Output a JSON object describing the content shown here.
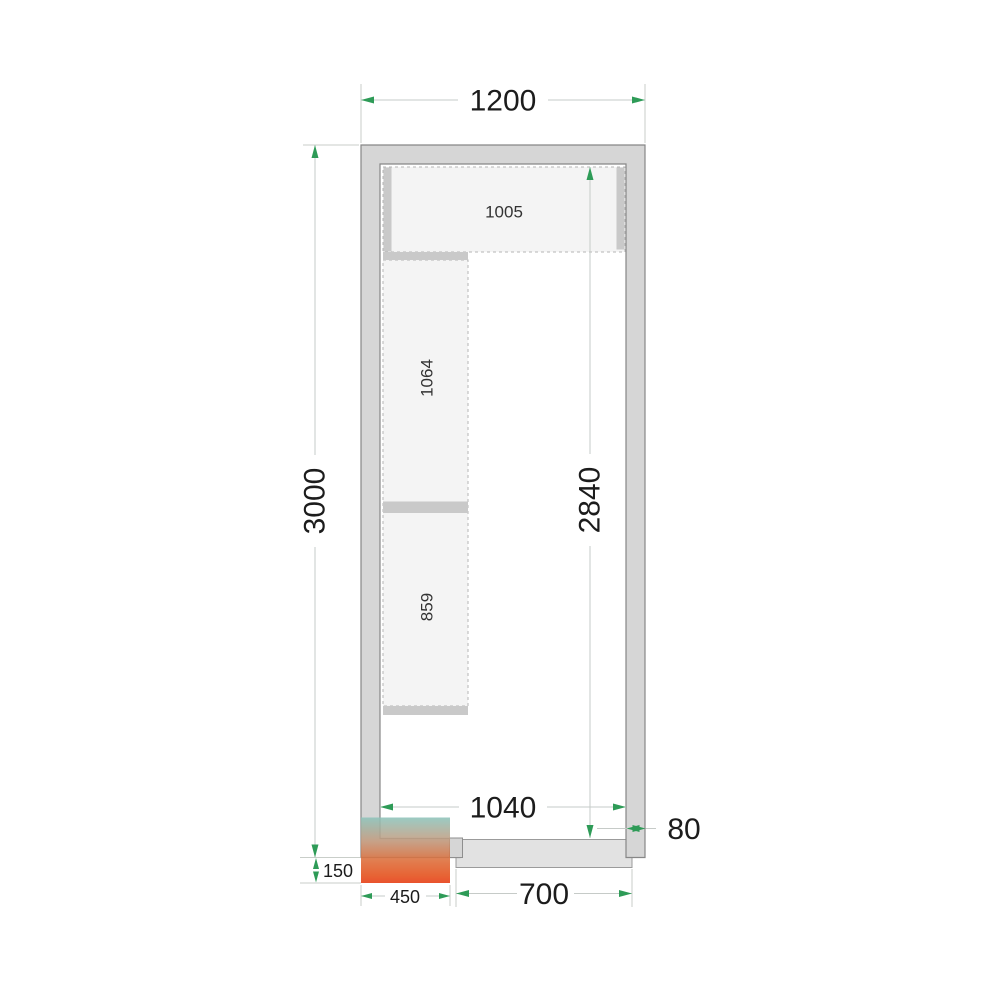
{
  "drawing": {
    "type": "cold-room-plan-top-view",
    "dims": {
      "outer_width": "1200",
      "outer_height": "3000",
      "inner_height": "2840",
      "inner_width": "1040",
      "wall_thickness": "80",
      "unit_overhang": "150",
      "unit_width": "450",
      "door_width": "700"
    },
    "shelves": {
      "top": "1005",
      "left_upper": "1064",
      "left_lower": "859"
    },
    "colors": {
      "arrow_green": "#2e9b57",
      "dim_line_gray": "#c6cbc8",
      "wall_fill": "#d6d6d6",
      "wall_border": "#878787",
      "shelf_fill": "#f4f4f4",
      "shelf_dash": "#b6b6b6",
      "support_bar": "#c9c9c9",
      "door_fill": "#e2e2e2",
      "text": "#1c1c1c",
      "unit_gradient_top": "#8cc3ba",
      "unit_gradient_mid": "#dd6a35",
      "unit_gradient_bottom": "#e6380e"
    }
  }
}
